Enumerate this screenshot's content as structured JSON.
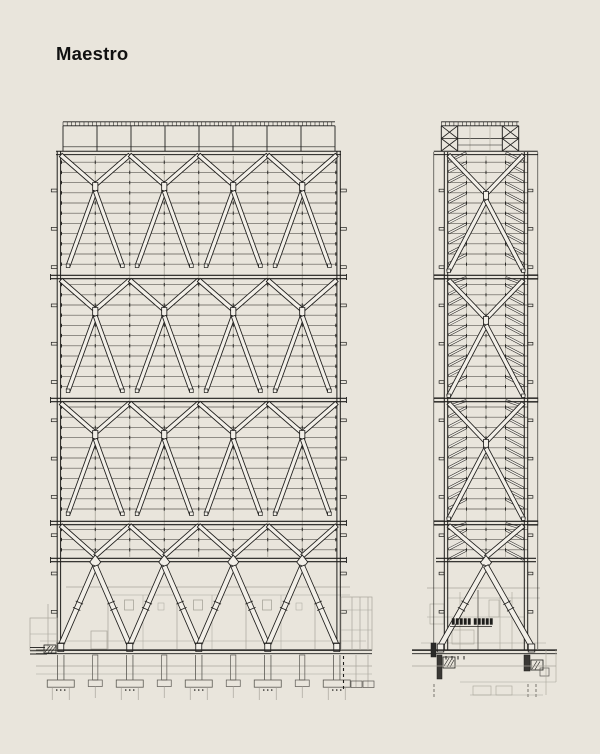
{
  "title": "Maestro",
  "diagram": {
    "description": "Two structural steel elevations of a diagrid tower: wide front elevation (left) and narrow side elevation (right), over a podium with foundations",
    "colors": {
      "background": "#e9e5dc",
      "ink": "#1f1e1c",
      "mid": "#5a5852",
      "light": "#a8a59b",
      "member_fill": "#f2efe8",
      "title": "#111111"
    },
    "front": {
      "lattice_left": 60.75,
      "lattice_right": 336.75,
      "bays": 4,
      "top_chord_y": 152,
      "bands": [
        277,
        400,
        523
      ],
      "bottom_chord_y": 560,
      "floor_spacing": 10.2,
      "ground_y": 650,
      "foundation_bottom_y": 700,
      "roof": {
        "left": 63,
        "right": 335,
        "rail_y": 121.8,
        "tick_spacing": 4.2,
        "post_count": 9
      }
    },
    "side": {
      "offset_left": 433.8,
      "offset_right": 537.8,
      "col_left": 446,
      "col_right": 526,
      "top_chord_y": 152,
      "bands": [
        277,
        400,
        523
      ],
      "bottom_chord_y": 560,
      "floor_spacing": 10.2,
      "ground_y": 650,
      "mullions": [
        466.5,
        486,
        505.5
      ],
      "roof": {
        "left": 441.3,
        "right": 518.7,
        "inner_left": 457.7,
        "inner_right": 502.3,
        "rail_y": 121.8,
        "mid_y": 138.5
      }
    }
  }
}
